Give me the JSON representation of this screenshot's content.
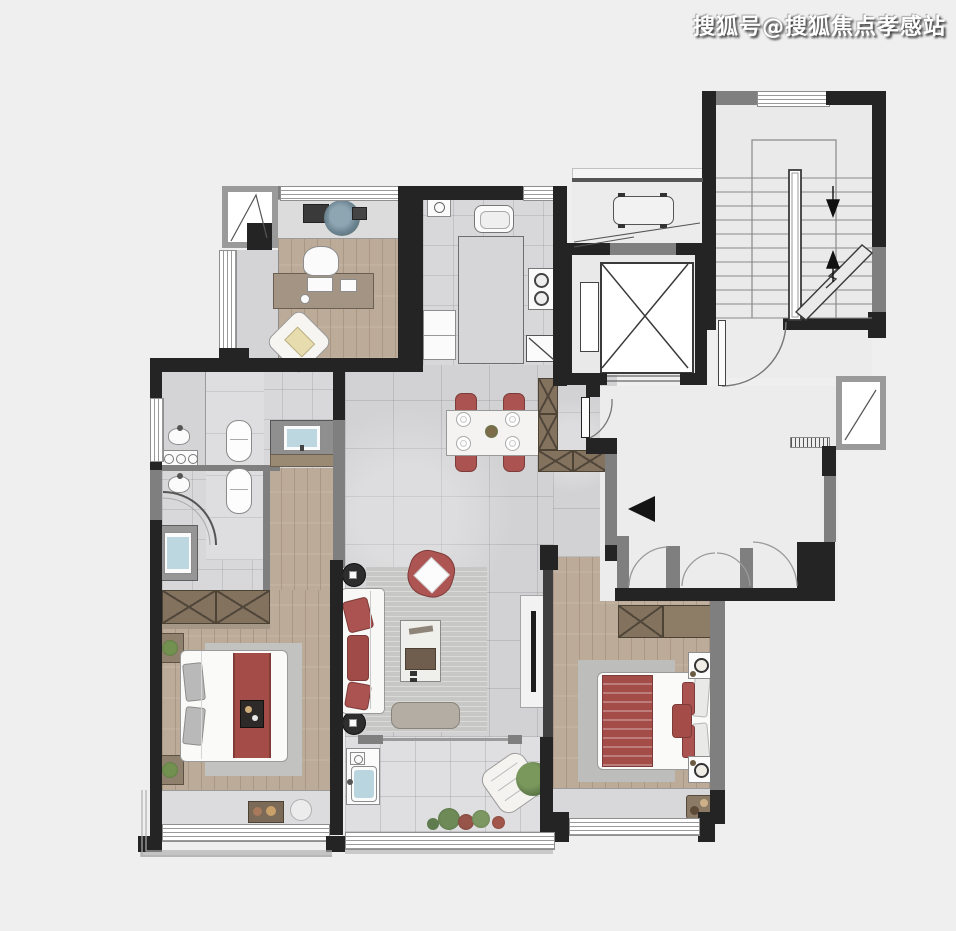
{
  "watermark": {
    "text": "搜狐号@搜狐焦点孝感站"
  },
  "palette": {
    "background": "#efefef",
    "wall_dark": "#242424",
    "wall_gray": "#7f7f7f",
    "tile_floor": "#d2d2d4",
    "wood_floor": "#bcab99",
    "accent_red": "#ab5350",
    "wardrobe_brown": "#83735e",
    "basin_blue": "#bcd7e0",
    "plant_green": "#5f7c4e",
    "watermark_color": "#ffffff"
  },
  "floorplan": {
    "type": "residential-apartment-floorplan-render",
    "rooms": [
      {
        "name": "study"
      },
      {
        "name": "kitchen"
      },
      {
        "name": "dining-hall"
      },
      {
        "name": "living-room"
      },
      {
        "name": "bathroom"
      },
      {
        "name": "bedroom-left"
      },
      {
        "name": "bedroom-right"
      },
      {
        "name": "balcony"
      },
      {
        "name": "elevator-shaft"
      },
      {
        "name": "stairwell"
      },
      {
        "name": "public-corridor"
      },
      {
        "name": "ac-platform"
      }
    ],
    "furniture_icons": [
      "desk",
      "office-chair",
      "lounge-chair",
      "console-plant",
      "kitchen-sink",
      "stove",
      "fridge",
      "kitchen-island",
      "dining-table",
      "dining-chair",
      "shoe-cabinet",
      "entry-door",
      "sofa",
      "armchair",
      "coffee-table",
      "tv-console",
      "bench",
      "side-table",
      "bed",
      "nightstand",
      "wardrobe",
      "toilet",
      "wash-basin",
      "shower",
      "washer",
      "laundry-sink",
      "plants",
      "elevator-car"
    ]
  }
}
